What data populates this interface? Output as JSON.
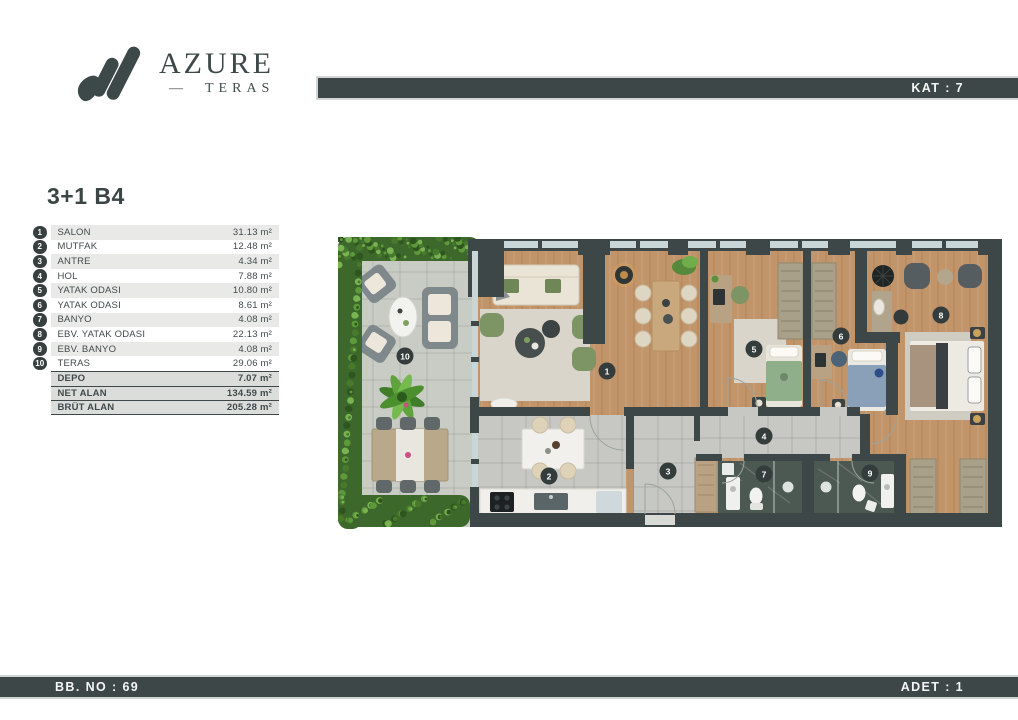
{
  "brand": {
    "name": "AZURE",
    "dash": "—",
    "sub": "TERAS"
  },
  "header": {
    "floor": "KAT : 7"
  },
  "unit": {
    "title": "3+1 B4"
  },
  "legend": {
    "rows": [
      {
        "num": "1",
        "name": "SALON",
        "area": "31.13 m²"
      },
      {
        "num": "2",
        "name": "MUTFAK",
        "area": "12.48 m²"
      },
      {
        "num": "3",
        "name": "ANTRE",
        "area": "4.34 m²"
      },
      {
        "num": "4",
        "name": "HOL",
        "area": "7.88 m²"
      },
      {
        "num": "5",
        "name": "YATAK ODASI",
        "area": "10.80 m²"
      },
      {
        "num": "6",
        "name": "YATAK ODASI",
        "area": "8.61 m²"
      },
      {
        "num": "7",
        "name": "BANYO",
        "area": "4.08 m²"
      },
      {
        "num": "8",
        "name": "EBV. YATAK ODASI",
        "area": "22.13 m²"
      },
      {
        "num": "9",
        "name": "EBV. BANYO",
        "area": "4.08 m²"
      },
      {
        "num": "10",
        "name": "TERAS",
        "area": "29.06 m²"
      }
    ],
    "summary": [
      {
        "name": "DEPO",
        "area": "7.07 m²"
      },
      {
        "name": "NET ALAN",
        "area": "134.59 m²"
      },
      {
        "name": "BRÜT ALAN",
        "area": "205.28 m²"
      }
    ]
  },
  "plan": {
    "markers": [
      "1",
      "2",
      "3",
      "4",
      "5",
      "6",
      "7",
      "8",
      "9",
      "10"
    ]
  },
  "footer": {
    "left": "BB. NO : 69",
    "right": "ADET : 1"
  },
  "colors": {
    "accent": "#3d4747",
    "wood": "#c2946a",
    "tile": "#c7c8c3",
    "terrace_tile": "#c9ccc5",
    "dark_tile": "#4c5852",
    "hedge": "#3c682c",
    "window": "#c9d6d7",
    "row_alt": "#e9eae8",
    "summary_bg": "#dbdddb"
  }
}
